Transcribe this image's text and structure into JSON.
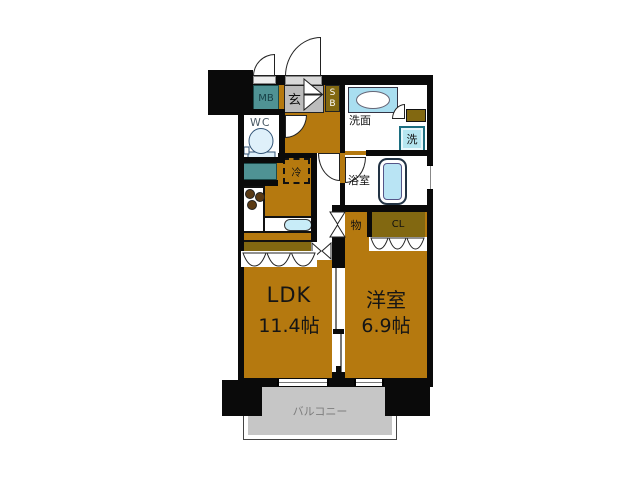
{
  "title": "apartment-floor-plan",
  "rooms": {
    "meter_box": {
      "label": "MB"
    },
    "entrance": {
      "label": "玄"
    },
    "shoe_box": {
      "label": "S\nB"
    },
    "washroom": {
      "label": "洗面"
    },
    "washer": {
      "label": "洗"
    },
    "toilet_room": {
      "label": "WC"
    },
    "refrigerator": {
      "label": "冷"
    },
    "bathroom": {
      "label": "浴室"
    },
    "storage": {
      "label": "物"
    },
    "closet": {
      "label": "CL"
    },
    "ldk": {
      "label": "LDK",
      "size": "11.4帖"
    },
    "western_room": {
      "label": "洋室",
      "size": "6.9帖"
    },
    "balcony": {
      "label": "バルコニー"
    }
  },
  "colors": {
    "wall": "#0a0a0a",
    "floor_brown": "#b5790f",
    "olive_fixture": "#826811",
    "teal_box": "#4f9294",
    "entrance_gray": "#bcbcbc",
    "balcony_gray": "#c6c6c6",
    "fixture_blue": "#a9def0",
    "tub_blue": "#b9e4f4",
    "background": "#ffffff"
  }
}
